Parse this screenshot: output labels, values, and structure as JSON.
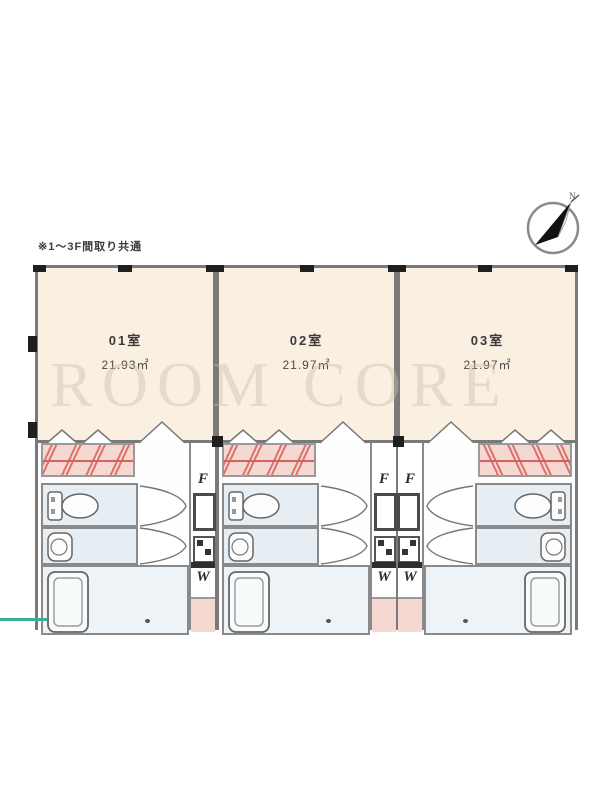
{
  "caption": "※1〜3F間取り共通",
  "watermark": "ROOM CORE",
  "compass": {
    "north_label": "N"
  },
  "fixture_labels": {
    "refrigerator": "F",
    "washer": "W"
  },
  "units": [
    {
      "id": "01",
      "name": "01室",
      "area": "21.93㎡"
    },
    {
      "id": "02",
      "name": "02室",
      "area": "21.97㎡"
    },
    {
      "id": "03",
      "name": "03室",
      "area": "21.97㎡"
    }
  ],
  "colors": {
    "living_cream": "#faf0e2",
    "closet_pink": "#f6d8d3",
    "wet_room_blue": "#e6eef3",
    "wall_gray": "#7a7a7a",
    "hatch_red": "#d6605c",
    "accent_teal": "#3fae96"
  }
}
